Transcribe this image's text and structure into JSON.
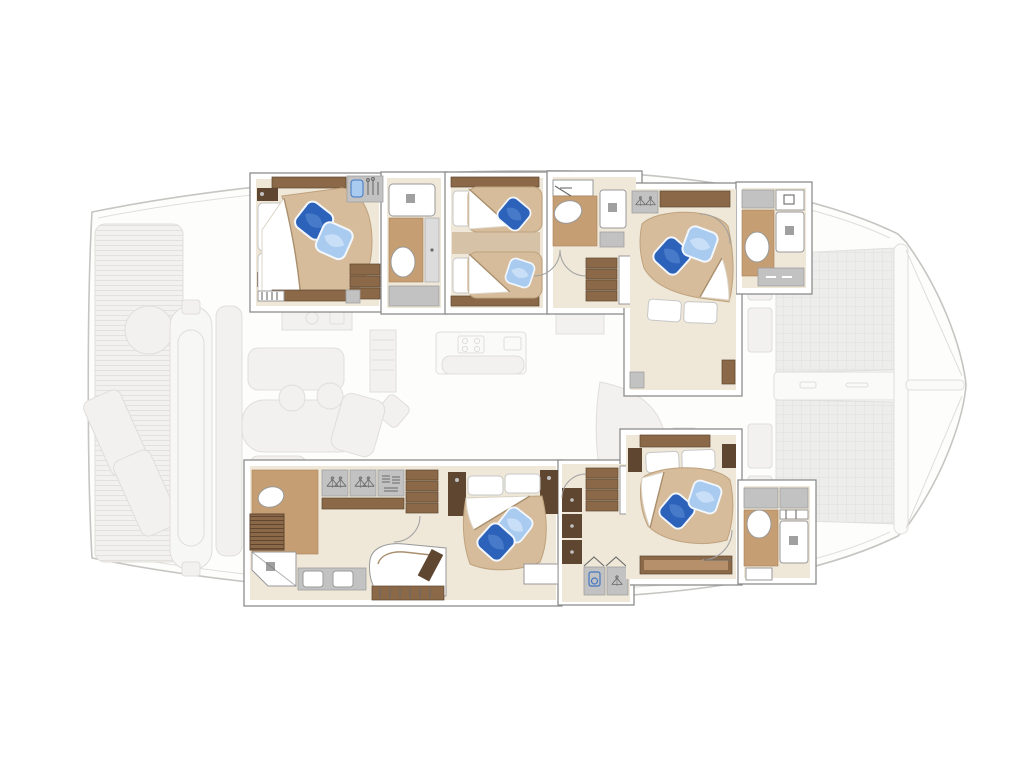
{
  "title": "Catamaran yacht interior deck plan — five cabin layout",
  "palette": {
    "background": "#ffffff",
    "outline": "#c6c5c2",
    "faded_fill": "#f2f1ef",
    "faded_stroke": "#e0deda",
    "faded_detail": "#e9e8e5",
    "slat": "#e3e1dd",
    "tramp_fill": "#ededec",
    "tramp_line": "#e0e0df",
    "wall": "#ffffff",
    "wall_stroke": "#8d8d8d",
    "floor": "#efe8d9",
    "bath_floor": "#c69e73",
    "bath_floor_dark": "#ab8155",
    "wood": "#8a6848",
    "wood_dark": "#5f4630",
    "wood_light": "#b5906a",
    "cabinet": "#c2c2c2",
    "cabinet_dark": "#a0a0a0",
    "cabinet_light": "#dcdcdc",
    "fixture": "#ffffff",
    "fixture_stroke": "#999999",
    "bed_tan": "#d6bc9a",
    "bed_tan_dark": "#bfa27e",
    "bed_tan_shadow": "#a98f6e",
    "sheet": "#ffffff",
    "sheet_shadow": "#dcd5c8",
    "pillow_dark": "#2d62bb",
    "pillow_dark_hi": "#6291d8",
    "pillow_light": "#a9cbf0",
    "pillow_light_hi": "#d7e7f9",
    "pillow_edge": "#f2f7fd",
    "glyph": "#6a6a6a",
    "glyph_blue": "#4377c2",
    "arc": "#9f9f9f"
  },
  "vessel": {
    "style": "sailing catamaran, top-down interior plan, bow to the right",
    "highlighted_areas": "cabins and bathrooms in both hulls (full colour)",
    "faded_areas": [
      "stern swim platforms",
      "tender between sterns",
      "aft cockpit seating and table",
      "saloon with galley island",
      "foredeck trampoline",
      "forward crossbeam and bowsprit"
    ]
  },
  "upper_hull": {
    "name": "port hull (top)",
    "rooms": [
      {
        "id": "guest-cabin-aft-port",
        "name": "aft guest cabin",
        "features": [
          "double bed with white headboard cushions",
          "tan quilt with folded white sheet",
          "dark blue decor pillow",
          "light blue decor pillow",
          "vanity with blue sink and taps",
          "wood shelf trim",
          "storage steps"
        ]
      },
      {
        "id": "head-aft-port",
        "name": "aft port bathroom",
        "features": [
          "shower tray with drain",
          "teak floor",
          "toilet",
          "tall cabinet column"
        ]
      },
      {
        "id": "guest-cabin-mid-port",
        "name": "middle guest cabin",
        "features": [
          "two single beds",
          "white berth pillows",
          "tan quilts with white sheet folds",
          "dark blue decor pillow",
          "light blue decor pillow",
          "wood shelf trim"
        ]
      },
      {
        "id": "head-mid-port",
        "name": "middle port bathroom",
        "features": [
          "vanity counter",
          "toilet on teak floor",
          "separate shower cabin with drain"
        ]
      },
      {
        "id": "companionway-port",
        "name": "port companionway",
        "features": [
          "four wood steps down",
          "door swing arcs",
          "white landing"
        ]
      },
      {
        "id": "guest-cabin-fwd-port",
        "name": "forward port guest cabin",
        "features": [
          "angled double bed",
          "two white berth pillows",
          "dark blue decor pillow",
          "light blue decor pillow",
          "wardrobe with hangers",
          "wood shelf",
          "entry door arc"
        ]
      },
      {
        "id": "head-fwd-port",
        "name": "forward port bathroom",
        "features": [
          "cabinets",
          "vanity",
          "toilet on teak floor",
          "shower with drain",
          "slatted locker"
        ]
      }
    ]
  },
  "lower_hull": {
    "name": "starboard hull (bottom)",
    "rooms": [
      {
        "id": "owner-bathroom",
        "name": "owner bathroom",
        "features": [
          "toilet on teak floor",
          "louvered wood locker",
          "shower with glass door",
          "double washbasin counter"
        ]
      },
      {
        "id": "owner-dressing",
        "name": "owner dressing area",
        "features": [
          "two wardrobes with hangers",
          "shelf with folded clothes",
          "wood shelf band",
          "open shelf unit",
          "door swing arc"
        ]
      },
      {
        "id": "owner-lounge",
        "name": "owner lounge / desk",
        "features": [
          "curved sofa",
          "wood side table",
          "drawer front unit"
        ]
      },
      {
        "id": "owner-bedroom",
        "name": "owner bedroom",
        "features": [
          "large double bed",
          "two white berth pillows",
          "tan quilt with diagonal sheet fold",
          "dark blue decor pillow",
          "light blue decor pillow",
          "dark wood bedside cabinets",
          "bench seat"
        ]
      },
      {
        "id": "companionway-starboard",
        "name": "starboard companionway",
        "features": [
          "four wood steps down",
          "dark wood locker column",
          "washing machine cabinet",
          "hanging locker",
          "bifold doors"
        ]
      },
      {
        "id": "guest-cabin-fwd-starboard",
        "name": "forward starboard guest cabin",
        "features": [
          "angled double bed",
          "two white berth pillows",
          "dark blue decor pillow",
          "light blue decor pillow",
          "wood bedside blocks",
          "long wood bench shelf",
          "entry door arc"
        ]
      },
      {
        "id": "head-fwd-starboard",
        "name": "forward starboard bathroom",
        "features": [
          "cabinets",
          "toilet on teak floor",
          "towel rail",
          "shower with drain",
          "vanity"
        ]
      }
    ]
  },
  "exterior_faded": {
    "items": [
      "stern platform with teak slats",
      "two sun loungers",
      "round cockpit table",
      "tender / dinghy stowed between hulls",
      "aft bench",
      "cockpit dining table with seats",
      "wet bar with grill and sink",
      "galley island with four burner stove and sink",
      "saloon sofa",
      "chart cabinet",
      "side deck lockers",
      "trampoline net grid (two panels)",
      "central forward walkway",
      "forward crossbeam",
      "bowsprit pole"
    ]
  },
  "counts": {
    "double_beds": 4,
    "single_beds": 2,
    "bathrooms": 5,
    "toilets": 5,
    "showers": 5,
    "companionway_stairs": 2,
    "blue_decor_pillows": 10,
    "wardrobe_hanger_units": 5
  }
}
